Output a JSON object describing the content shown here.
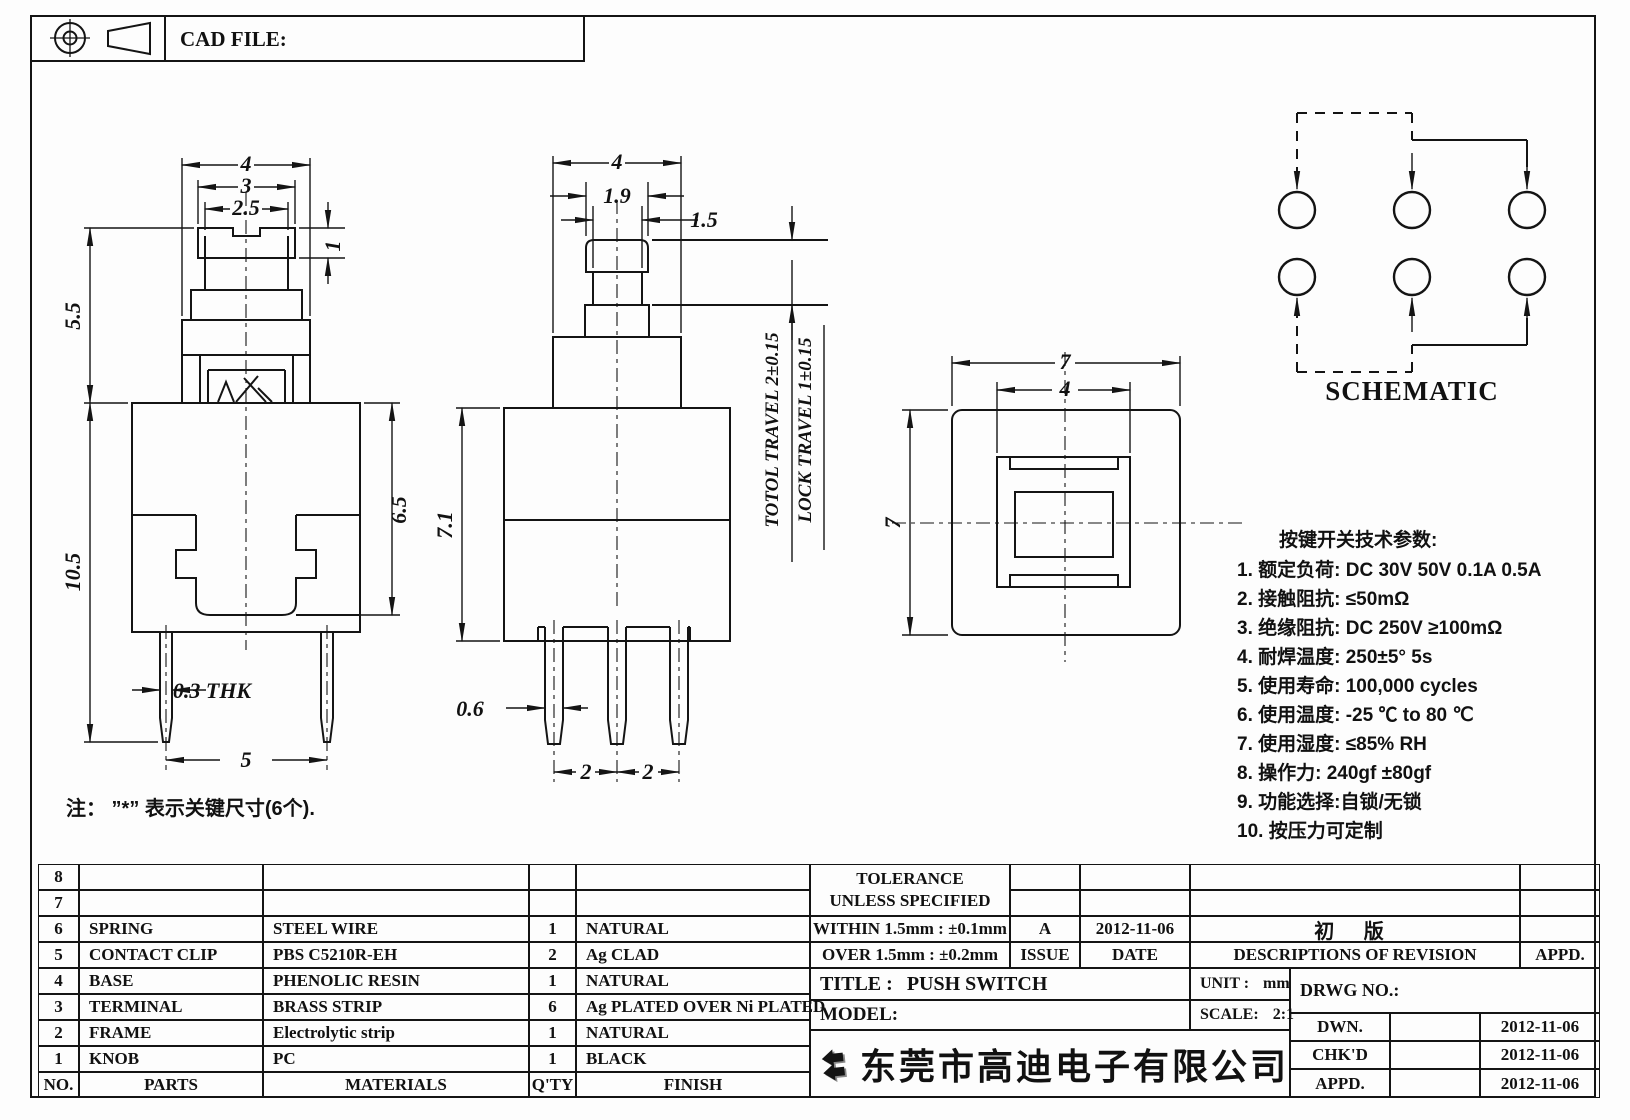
{
  "sheet": {
    "cad_file_label": "CAD FILE:"
  },
  "views": {
    "front": {
      "dim_top_outer": "4",
      "dim_top_mid": "3",
      "dim_top_inner": "2.5",
      "dim_cap_height": "1",
      "dim_upper_height": "5.5",
      "dim_total_height": "10.5",
      "dim_body_height": "6.5",
      "dim_pin_thickness": "0.3 THK",
      "dim_pin_spacing": "5"
    },
    "side": {
      "dim_top_outer": "4",
      "dim_cap_width": "1.9",
      "dim_stem_width": "1.5",
      "dim_body_height": "7.1",
      "dim_pin_width": "0.6",
      "dim_pin_pitch_left": "2",
      "dim_pin_pitch_right": "2",
      "total_travel": "TOTOL TRAVEL 2±0.15",
      "lock_travel": "LOCK TRAVEL 1±0.15"
    },
    "top": {
      "dim_outer_width": "7",
      "dim_inner_width": "4",
      "dim_outer_height": "7"
    },
    "schematic": {
      "label": "SCHEMATIC"
    }
  },
  "note": "注： ”*”  表示关键尺寸(6个).",
  "tech_params": {
    "title": "按键开关技术参数:",
    "items": [
      "1. 额定负荷: DC 30V 50V   0.1A  0.5A",
      "2. 接触阻抗: ≤50mΩ",
      "3. 绝缘阻抗: DC 250V ≥100mΩ",
      "4. 耐焊温度: 250±5°  5s",
      "5. 使用寿命: 100,000 cycles",
      "6. 使用温度: -25 ℃ to 80 ℃",
      "7. 使用湿度: ≤85% RH",
      "8. 操作力: 240gf ±80gf",
      "9. 功能选择:自锁/无锁",
      "10. 按压力可定制"
    ]
  },
  "parts_table": {
    "headers": {
      "no": "NO.",
      "parts": "PARTS",
      "materials": "MATERIALS",
      "qty": "Q'TY",
      "finish": "FINISH"
    },
    "rows": [
      {
        "no": "8",
        "parts": "",
        "materials": "",
        "qty": "",
        "finish": ""
      },
      {
        "no": "7",
        "parts": "",
        "materials": "",
        "qty": "",
        "finish": ""
      },
      {
        "no": "6",
        "parts": "SPRING",
        "materials": "STEEL WIRE",
        "qty": "1",
        "finish": "NATURAL"
      },
      {
        "no": "5",
        "parts": "CONTACT CLIP",
        "materials": "PBS C5210R-EH",
        "qty": "2",
        "finish": "Ag CLAD"
      },
      {
        "no": "4",
        "parts": "BASE",
        "materials": "PHENOLIC RESIN",
        "qty": "1",
        "finish": "NATURAL"
      },
      {
        "no": "3",
        "parts": "TERMINAL",
        "materials": "BRASS STRIP",
        "qty": "6",
        "finish": "Ag PLATED OVER Ni PLATED"
      },
      {
        "no": "2",
        "parts": "FRAME",
        "materials": "Electrolytic strip",
        "qty": "1",
        "finish": "NATURAL"
      },
      {
        "no": "1",
        "parts": "KNOB",
        "materials": "PC",
        "qty": "1",
        "finish": "BLACK"
      }
    ]
  },
  "title_block": {
    "tolerance_title": "TOLERANCE",
    "tolerance_subtitle": "UNLESS  SPECIFIED",
    "within": "WITHIN 1.5mm : ±0.1mm",
    "over": "OVER 1.5mm : ±0.2mm",
    "issue_value": "A",
    "issue_label": "ISSUE",
    "date_value": "2012-11-06",
    "date_label": "DATE",
    "revision_desc": "初 版",
    "revision_header": "DESCRIPTIONS OF REVISION",
    "revision_appd_header": "APPD.",
    "title_label": "TITLE :",
    "title_value": "PUSH SWITCH",
    "model_label": "MODEL:",
    "unit_label": "UNIT :",
    "unit_value": "mm",
    "scale_label": "SCALE:",
    "scale_value": "2:1",
    "drwg_label": "DRWG NO.:",
    "sign_rows": [
      {
        "label": "DWN.",
        "name": "",
        "date": "2012-11-06"
      },
      {
        "label": "CHK'D",
        "name": "",
        "date": "2012-11-06"
      },
      {
        "label": "APPD.",
        "name": "",
        "date": "2012-11-06"
      }
    ],
    "company": "东莞市高迪电子有限公司"
  }
}
